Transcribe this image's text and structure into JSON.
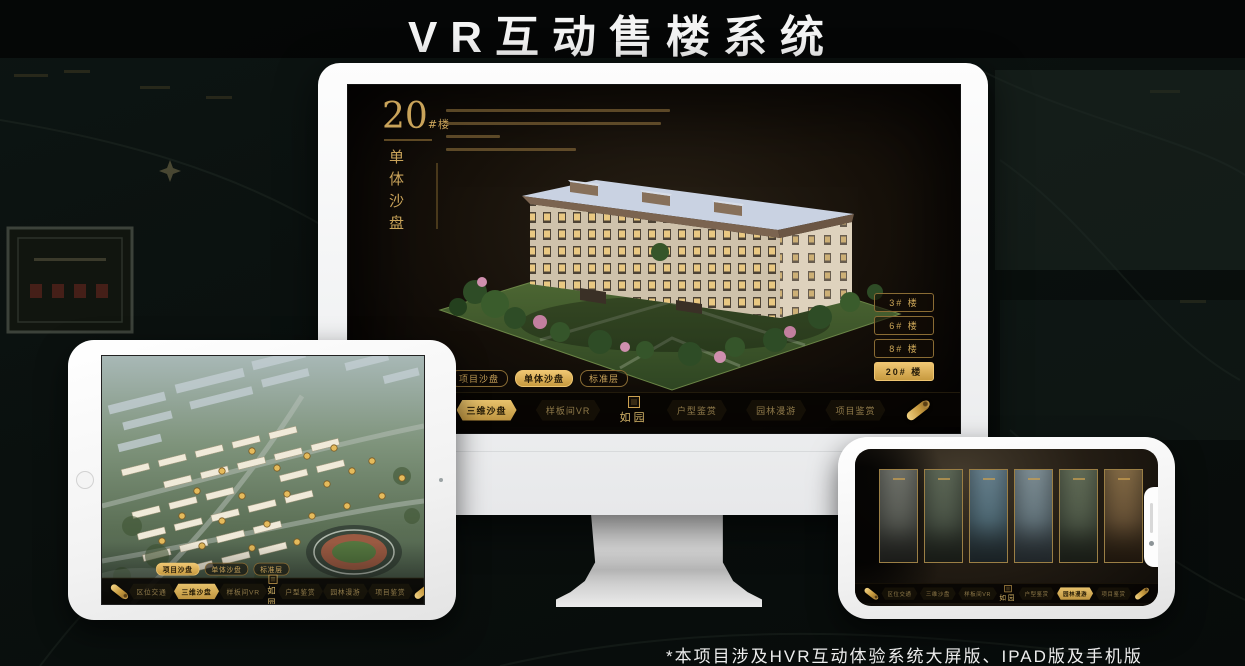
{
  "page": {
    "title": "VR互动售楼系统",
    "footnote": "*本项目涉及HVR互动体验系统大屏版、IPAD版及手机版"
  },
  "colors": {
    "accent_gold": "#c9a35a",
    "accent_gold_bright": "#efc672",
    "screen_background": "#17110a",
    "page_background": "#0a100e"
  },
  "sales_app": {
    "logo": "如园",
    "tabs": [
      "项目沙盘",
      "单体沙盘",
      "标准层"
    ],
    "nav_items": [
      "区位交通",
      "三维沙盘",
      "样板间VR",
      "户型鉴赏",
      "园林漫游",
      "项目鉴赏"
    ]
  },
  "monitor": {
    "floor_number": "20",
    "floor_unit": "#楼",
    "subtitle": "单体沙盘",
    "floor_buttons": [
      "3# 楼",
      "6# 楼",
      "8# 楼",
      "20# 楼"
    ],
    "active_floor": "20# 楼",
    "active_tab": "单体沙盘",
    "active_nav": "三维沙盘"
  },
  "tablet": {
    "active_tab": "项目沙盘",
    "active_nav": "三维沙盘"
  },
  "phone": {
    "active_nav": "园林漫游"
  }
}
